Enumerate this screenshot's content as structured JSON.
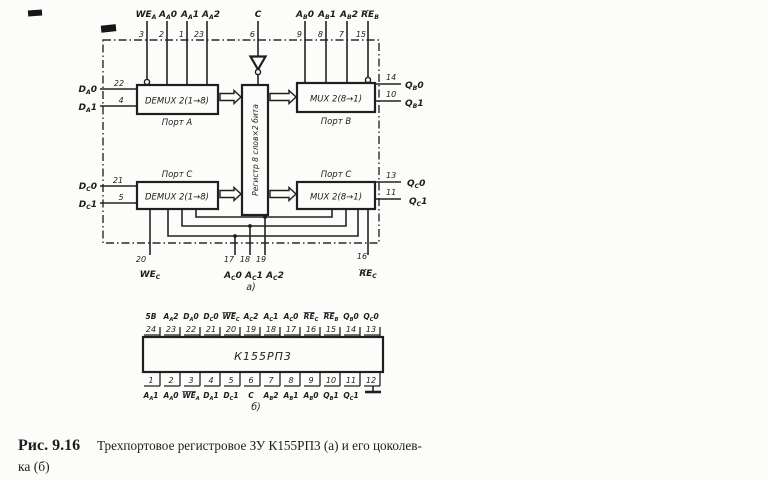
{
  "colors": {
    "ink": "#1d1d1d",
    "paper": "#fcfcfa"
  },
  "schematic": {
    "label": "а)",
    "blocks": {
      "demux_a": {
        "title": "DEMUX 2(1→8)",
        "port": "Порт А"
      },
      "mux_b": {
        "title": "MUX 2(8→1)",
        "port": "Порт В"
      },
      "demux_c": {
        "title": "DEMUX 2(1→8)",
        "port": "Порт С"
      },
      "mux_c": {
        "title": "MUX 2(8→1)",
        "port": "Порт С"
      },
      "register": {
        "title": "Регистр 8 слов×2 бита"
      }
    },
    "top_pins": [
      {
        "num": "3",
        "segs": [
          {
            "t": "WE",
            "s": "bar"
          },
          {
            "t": "A",
            "s": "sub"
          }
        ]
      },
      {
        "num": "2",
        "segs": [
          {
            "t": "A"
          },
          {
            "t": "A",
            "s": "sub"
          },
          {
            "t": "0"
          }
        ]
      },
      {
        "num": "1",
        "segs": [
          {
            "t": "A"
          },
          {
            "t": "A",
            "s": "sub"
          },
          {
            "t": "1"
          }
        ]
      },
      {
        "num": "23",
        "segs": [
          {
            "t": "A"
          },
          {
            "t": "A",
            "s": "sub"
          },
          {
            "t": "2"
          }
        ]
      },
      {
        "num": "6",
        "segs": [
          {
            "t": "C"
          }
        ]
      },
      {
        "num": "9",
        "segs": [
          {
            "t": "A"
          },
          {
            "t": "B",
            "s": "sub"
          },
          {
            "t": "0"
          }
        ]
      },
      {
        "num": "8",
        "segs": [
          {
            "t": "A"
          },
          {
            "t": "B",
            "s": "sub"
          },
          {
            "t": "1"
          }
        ]
      },
      {
        "num": "7",
        "segs": [
          {
            "t": "A"
          },
          {
            "t": "B",
            "s": "sub"
          },
          {
            "t": "2"
          }
        ]
      },
      {
        "num": "15",
        "segs": [
          {
            "t": "RE",
            "s": "bar"
          },
          {
            "t": "B",
            "s": "sub"
          }
        ]
      }
    ],
    "left_pins": [
      {
        "num": "22",
        "segs": [
          {
            "t": "D"
          },
          {
            "t": "A",
            "s": "sub"
          },
          {
            "t": "0"
          }
        ]
      },
      {
        "num": "4",
        "segs": [
          {
            "t": "D"
          },
          {
            "t": "A",
            "s": "sub"
          },
          {
            "t": "1"
          }
        ]
      },
      {
        "num": "21",
        "segs": [
          {
            "t": "D"
          },
          {
            "t": "C",
            "s": "sub"
          },
          {
            "t": "0"
          }
        ]
      },
      {
        "num": "5",
        "segs": [
          {
            "t": "D"
          },
          {
            "t": "C",
            "s": "sub"
          },
          {
            "t": "1"
          }
        ]
      }
    ],
    "right_pins": [
      {
        "num": "14",
        "segs": [
          {
            "t": "Q"
          },
          {
            "t": "B",
            "s": "sub"
          },
          {
            "t": "0"
          }
        ]
      },
      {
        "num": "10",
        "segs": [
          {
            "t": "Q"
          },
          {
            "t": "B",
            "s": "sub"
          },
          {
            "t": "1"
          }
        ]
      },
      {
        "num": "13",
        "segs": [
          {
            "t": "Q"
          },
          {
            "t": "C",
            "s": "sub"
          },
          {
            "t": "0"
          }
        ]
      },
      {
        "num": "11",
        "segs": [
          {
            "t": "Q"
          },
          {
            "t": "C",
            "s": "sub"
          },
          {
            "t": "1"
          }
        ]
      }
    ],
    "bottom_pins": [
      {
        "num": "20",
        "segs": [
          {
            "t": "WE",
            "s": "bar"
          },
          {
            "t": "C",
            "s": "sub"
          }
        ]
      },
      {
        "num": "17",
        "segs": [
          {
            "t": "A"
          },
          {
            "t": "C",
            "s": "sub"
          },
          {
            "t": "0"
          }
        ]
      },
      {
        "num": "18",
        "segs": [
          {
            "t": "A"
          },
          {
            "t": "C",
            "s": "sub"
          },
          {
            "t": "1"
          }
        ]
      },
      {
        "num": "19",
        "segs": [
          {
            "t": "A"
          },
          {
            "t": "C",
            "s": "sub"
          },
          {
            "t": "2"
          }
        ]
      },
      {
        "num": "16",
        "segs": [
          {
            "t": "RE",
            "s": "bar"
          },
          {
            "t": "C",
            "s": "sub"
          }
        ]
      }
    ]
  },
  "pinout": {
    "label": "б)",
    "chip": "К155РП3",
    "top_pins": [
      {
        "num": "24",
        "segs": [
          {
            "t": "5В"
          }
        ]
      },
      {
        "num": "23",
        "segs": [
          {
            "t": "A"
          },
          {
            "t": "A",
            "s": "sub"
          },
          {
            "t": "2"
          }
        ]
      },
      {
        "num": "22",
        "segs": [
          {
            "t": "D"
          },
          {
            "t": "A",
            "s": "sub"
          },
          {
            "t": "0"
          }
        ]
      },
      {
        "num": "21",
        "segs": [
          {
            "t": "D"
          },
          {
            "t": "C",
            "s": "sub"
          },
          {
            "t": "0"
          }
        ]
      },
      {
        "num": "20",
        "segs": [
          {
            "t": "WE",
            "s": "bar"
          },
          {
            "t": "C",
            "s": "sub"
          }
        ]
      },
      {
        "num": "19",
        "segs": [
          {
            "t": "A"
          },
          {
            "t": "C",
            "s": "sub"
          },
          {
            "t": "2"
          }
        ]
      },
      {
        "num": "18",
        "segs": [
          {
            "t": "A"
          },
          {
            "t": "C",
            "s": "sub"
          },
          {
            "t": "1"
          }
        ]
      },
      {
        "num": "17",
        "segs": [
          {
            "t": "A"
          },
          {
            "t": "C",
            "s": "sub"
          },
          {
            "t": "0"
          }
        ]
      },
      {
        "num": "16",
        "segs": [
          {
            "t": "RE",
            "s": "bar"
          },
          {
            "t": "C",
            "s": "sub"
          }
        ]
      },
      {
        "num": "15",
        "segs": [
          {
            "t": "RE",
            "s": "bar"
          },
          {
            "t": "B",
            "s": "sub"
          }
        ]
      },
      {
        "num": "14",
        "segs": [
          {
            "t": "Q"
          },
          {
            "t": "B",
            "s": "sub"
          },
          {
            "t": "0"
          }
        ]
      },
      {
        "num": "13",
        "segs": [
          {
            "t": "Q"
          },
          {
            "t": "C",
            "s": "sub"
          },
          {
            "t": "0"
          }
        ]
      }
    ],
    "bottom_pins": [
      {
        "num": "1",
        "segs": [
          {
            "t": "A"
          },
          {
            "t": "A",
            "s": "sub"
          },
          {
            "t": "1"
          }
        ]
      },
      {
        "num": "2",
        "segs": [
          {
            "t": "A"
          },
          {
            "t": "A",
            "s": "sub"
          },
          {
            "t": "0"
          }
        ]
      },
      {
        "num": "3",
        "segs": [
          {
            "t": "WE",
            "s": "bar"
          },
          {
            "t": "A",
            "s": "sub"
          }
        ]
      },
      {
        "num": "4",
        "segs": [
          {
            "t": "D"
          },
          {
            "t": "A",
            "s": "sub"
          },
          {
            "t": "1"
          }
        ]
      },
      {
        "num": "5",
        "segs": [
          {
            "t": "D"
          },
          {
            "t": "C",
            "s": "sub"
          },
          {
            "t": "1"
          }
        ]
      },
      {
        "num": "6",
        "segs": [
          {
            "t": "C"
          }
        ]
      },
      {
        "num": "7",
        "segs": [
          {
            "t": "A"
          },
          {
            "t": "B",
            "s": "sub"
          },
          {
            "t": "2"
          }
        ]
      },
      {
        "num": "8",
        "segs": [
          {
            "t": "A"
          },
          {
            "t": "B",
            "s": "sub"
          },
          {
            "t": "1"
          }
        ]
      },
      {
        "num": "9",
        "segs": [
          {
            "t": "A"
          },
          {
            "t": "B",
            "s": "sub"
          },
          {
            "t": "0"
          }
        ]
      },
      {
        "num": "10",
        "segs": [
          {
            "t": "Q"
          },
          {
            "t": "B",
            "s": "sub"
          },
          {
            "t": "1"
          }
        ]
      },
      {
        "num": "11",
        "segs": [
          {
            "t": "Q"
          },
          {
            "t": "C",
            "s": "sub"
          },
          {
            "t": "1"
          }
        ]
      },
      {
        "num": "12",
        "segs": []
      }
    ]
  },
  "caption": {
    "ref": "Рис. 9.16",
    "line1": "Трехпортовое регистровое ЗУ К155РП3 (а) и его цоколев-",
    "line2": "ка (б)"
  }
}
